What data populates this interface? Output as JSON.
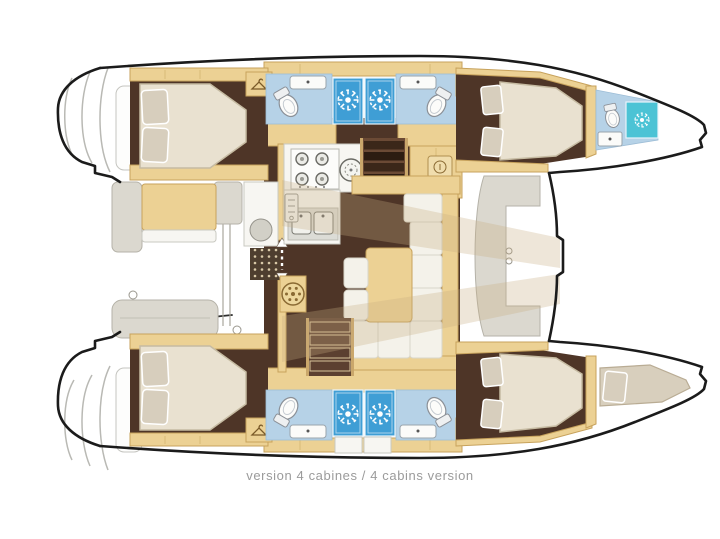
{
  "caption": "version 4 cabines / 4 cabins version",
  "colors": {
    "ink": "#1b1b1b",
    "wood": "#ecd194",
    "wood-edge": "#c7a25c",
    "floor": "#4e3527",
    "bed": "#e9e1d0",
    "bed-edge": "#c6bba2",
    "pillow": "#d7cebd",
    "bath": "#b6d2e7",
    "shower": "#3f9ed5",
    "teal": "#4cc3d5",
    "bench": "#dbd8cf",
    "cushion": "#f4f2ea",
    "overlay": "#c6ab80",
    "caption": "#9b9b9b",
    "scoop-line": "#b9b9b4"
  },
  "icons": {
    "shower_icon": "sun-burst",
    "wardrobe_icon": "coat-hanger",
    "toilet_icon": "oval-bowl",
    "sink_icon": "basin-with-tap",
    "stove_icon": "four-burner-grid",
    "aux_burner_icon": "round-burner",
    "fridge_icon": "vented-panel",
    "stairs_icon": "tread-bars",
    "door_icon": "double-arrow",
    "pedestal_icon": "spoked-circle"
  }
}
